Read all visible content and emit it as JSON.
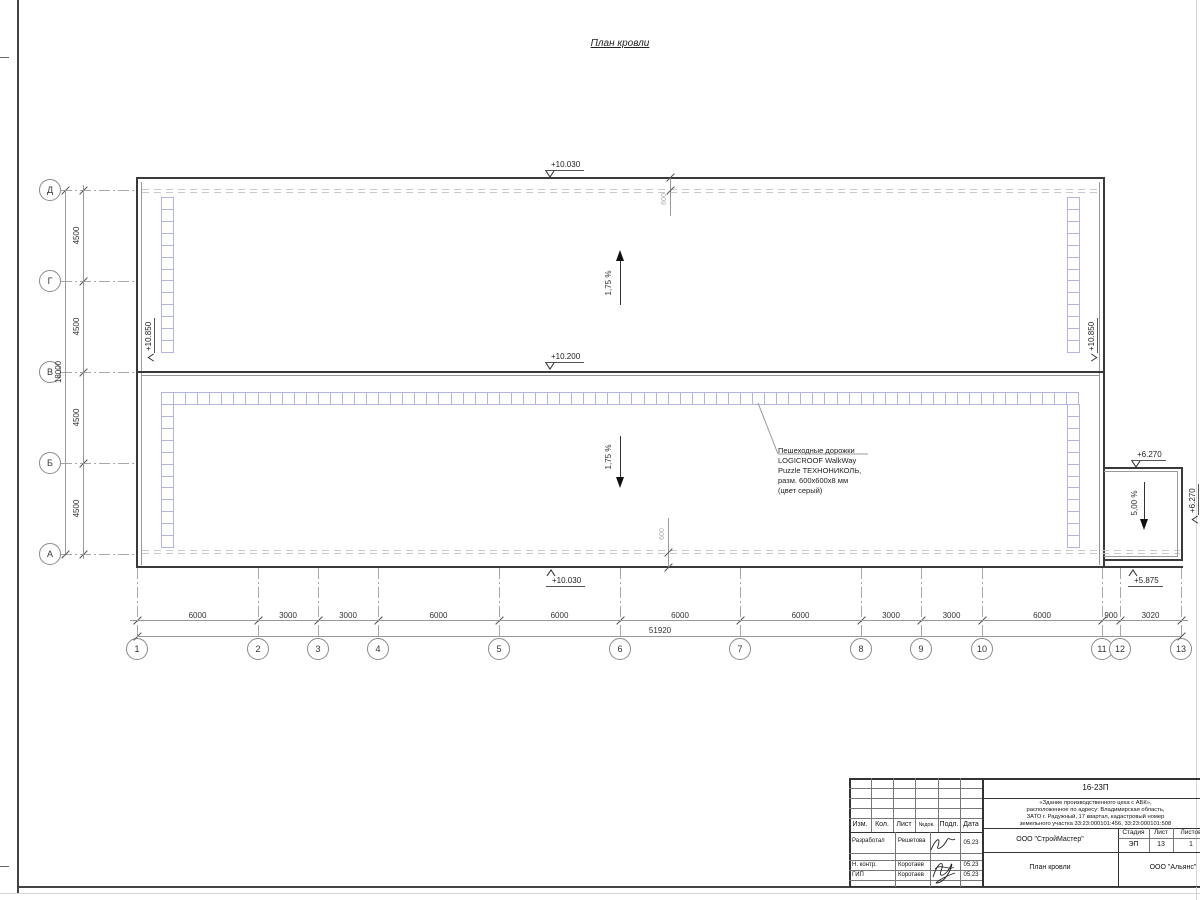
{
  "page": {
    "drawing_title": "План кровли"
  },
  "axes": {
    "rows": [
      "Д",
      "Г",
      "В",
      "Б",
      "А"
    ],
    "cols": [
      "1",
      "2",
      "3",
      "4",
      "5",
      "6",
      "7",
      "8",
      "9",
      "10",
      "11",
      "12",
      "13"
    ]
  },
  "dimensions": {
    "col_segments": [
      "6000",
      "3000",
      "3000",
      "6000",
      "6000",
      "6000",
      "6000",
      "3000",
      "3000",
      "6000",
      "900",
      "3020"
    ],
    "col_total": "51920",
    "row_segments": [
      "4500",
      "4500",
      "4500",
      "4500"
    ],
    "row_total": "18000",
    "parapet_offset_top": "600",
    "parapet_offset_bottom": "600"
  },
  "elevations": {
    "top_edge": "+10.030",
    "ridge": "+10.200",
    "bottom_edge": "+10.030",
    "left_wall": "+10.850",
    "right_wall": "+10.850",
    "canopy_top": "+6.270",
    "canopy_right": "+6.270",
    "canopy_bottom": "+5.875"
  },
  "slopes": {
    "upper": "1,75 %",
    "lower": "1,75 %",
    "canopy": "5,00 %"
  },
  "walkway": {
    "tile_color": "#b4b4e0",
    "note_lines": [
      "Пешеходные дорожки",
      "LOGICROOF WalkWay",
      "Puzzle ТЕХНОНИКОЛЬ,",
      "разм. 600х600х8 мм",
      "(цвет серый)"
    ],
    "strips": [
      {
        "name": "upper-left",
        "dir": "v",
        "x": 161,
        "y": 197,
        "count": 13
      },
      {
        "name": "upper-right",
        "dir": "v",
        "x": 1067,
        "y": 197,
        "count": 13
      },
      {
        "name": "lower-top",
        "dir": "h",
        "x": 161,
        "y": 392,
        "count": 76,
        "w": 918
      },
      {
        "name": "lower-left",
        "dir": "v",
        "x": 161,
        "y": 404,
        "count": 12
      },
      {
        "name": "lower-right",
        "dir": "v",
        "x": 1067,
        "y": 404,
        "count": 12
      }
    ]
  },
  "titleblock": {
    "doc_code": "16-23П",
    "project_lines": [
      "«Здание производственного цеха с АБК»,",
      "расположенное по адресу: Владимирская область,",
      "ЗАТО г. Радужный, 17 квартал, кадастровый номер",
      "земельного участка 33:23:000101:456, 33:23:000101:508"
    ],
    "org1": "ООО \"СтройМастер\"",
    "org2": "ООО \"Альянс\"",
    "sheet_title": "План кровли",
    "stage_label": "Стадия",
    "sheet_label": "Лист",
    "sheets_label": "Листов",
    "stage": "ЭП",
    "sheet": "13",
    "sheets": "1",
    "header_cols": [
      "Изм.",
      "Кол.",
      "Лист",
      "№док.",
      "Подл.",
      "Дата"
    ],
    "roles": [
      {
        "role": "Разработал",
        "name": "Решетова",
        "date": "05.23"
      },
      {
        "role": "Н. контр.",
        "name": "Коротаев",
        "date": "05.23"
      },
      {
        "role": "ГИП",
        "name": "Коротаев",
        "date": "05.23"
      }
    ]
  }
}
